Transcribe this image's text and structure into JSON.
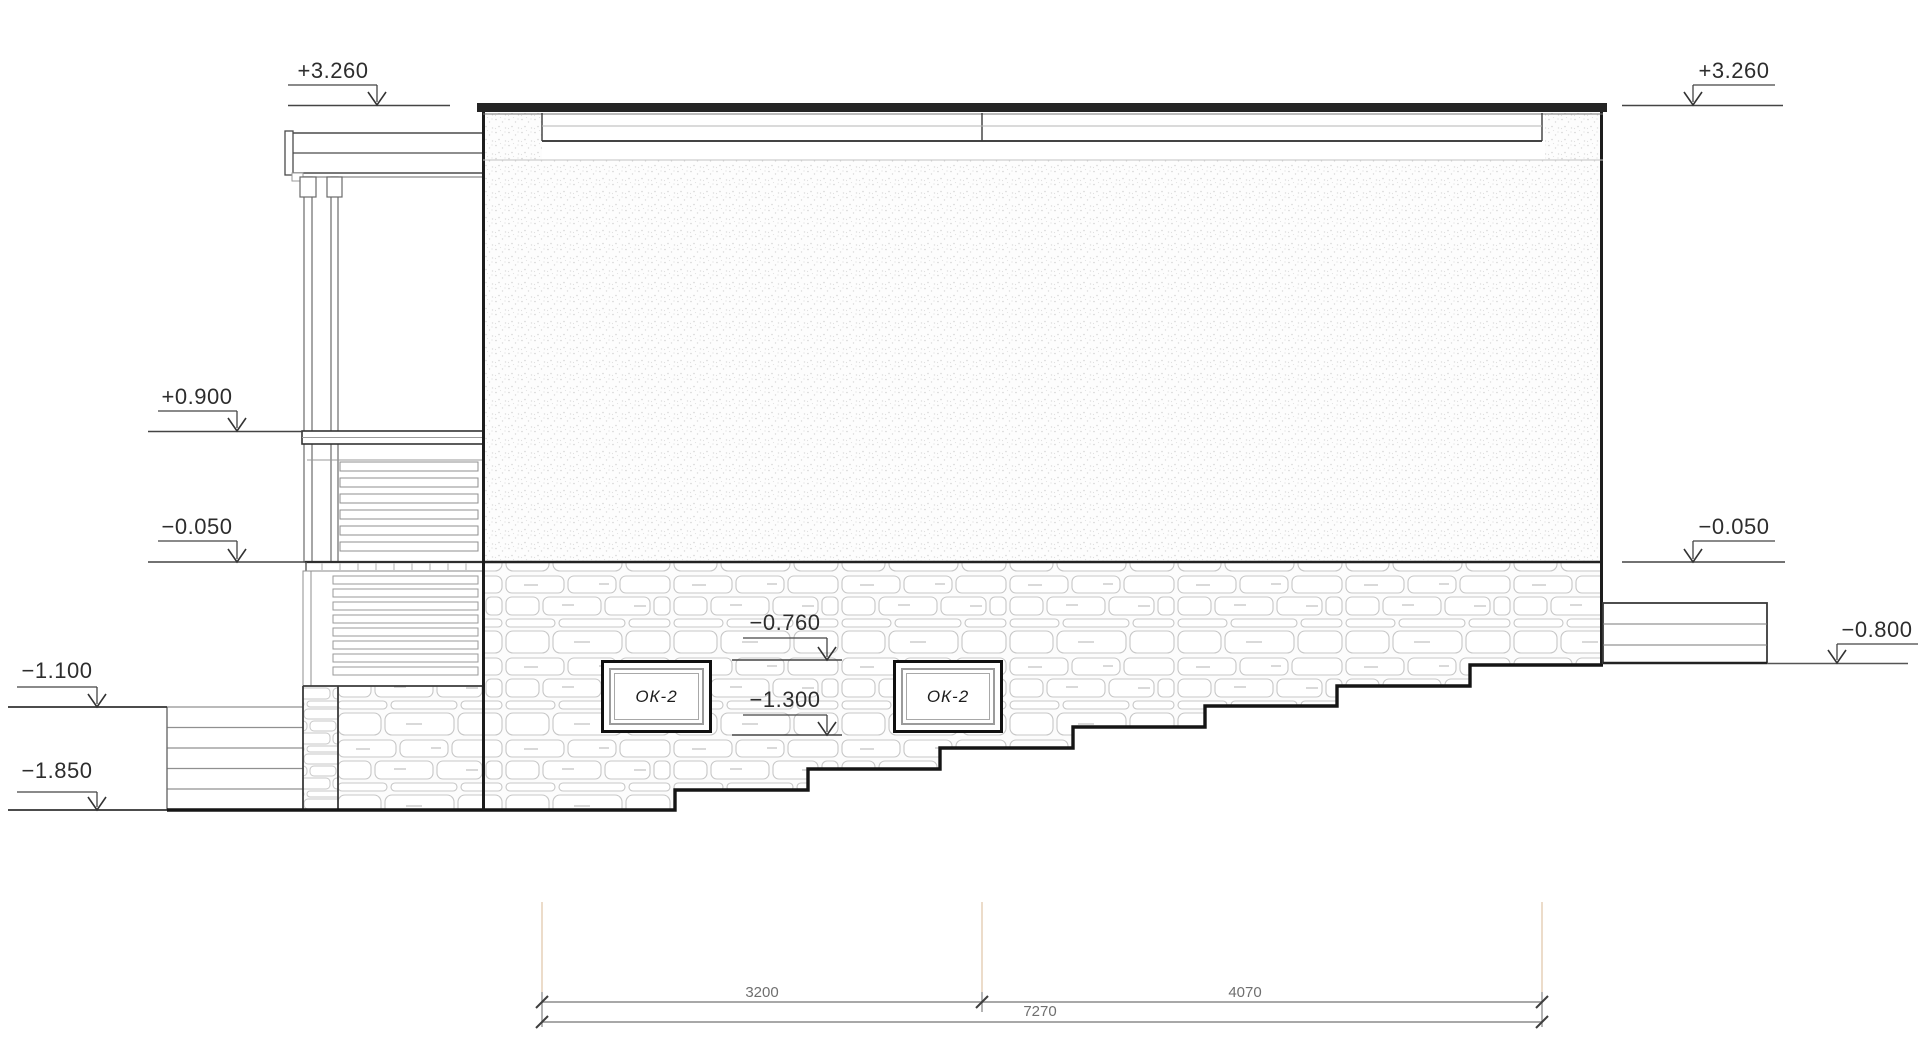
{
  "drawing_type": "building side elevation (stone basement, stucco wall, porch)",
  "elevation_marks": {
    "top_left": "+3.260",
    "top_right": "+3.260",
    "railing": "+0.900",
    "floor_left": "−0.050",
    "floor_right": "−0.050",
    "window_top": "−0.760",
    "window_bottom": "−1.300",
    "ground_left_upper": "−1.100",
    "ground_left_lower": "−1.850",
    "ground_right": "−0.800"
  },
  "windows": {
    "left_label": "ОК-2",
    "right_label": "ОК-2"
  },
  "dimensions": {
    "segment_left": "3200",
    "segment_right": "4070",
    "total": "7270"
  },
  "colors": {
    "linework": "#1c1c1c",
    "stone_outline": "#c7c7c7",
    "stipple_dot": "#d5d5d5",
    "extension_line": "#e7d4bd",
    "dimension_line": "#9c9c9c"
  }
}
